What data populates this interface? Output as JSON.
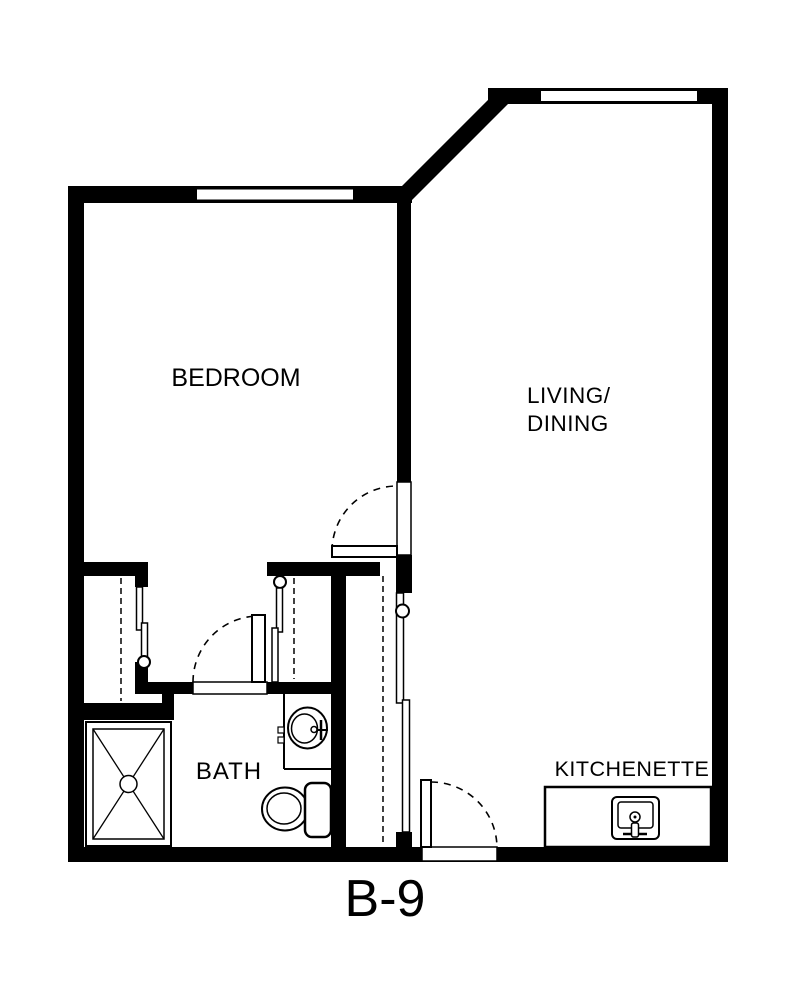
{
  "floorplan": {
    "unit_label": "B-9",
    "rooms": {
      "bedroom": {
        "label": "BEDROOM"
      },
      "living_dining": {
        "line1": "LIVING/",
        "line2": "DINING"
      },
      "bath": {
        "label": "BATH"
      },
      "kitchenette": {
        "label": "KITCHENETTE"
      }
    },
    "fixtures": [
      "bedroom-window",
      "living-window",
      "bedroom-closet",
      "linen-closet",
      "shower",
      "vanity-sink",
      "toilet",
      "kitchenette-sink",
      "bedroom-door",
      "bath-door",
      "entry-door",
      "hall-sliding-door"
    ],
    "colors": {
      "walls": "#000000",
      "floor": "#ffffff"
    }
  }
}
